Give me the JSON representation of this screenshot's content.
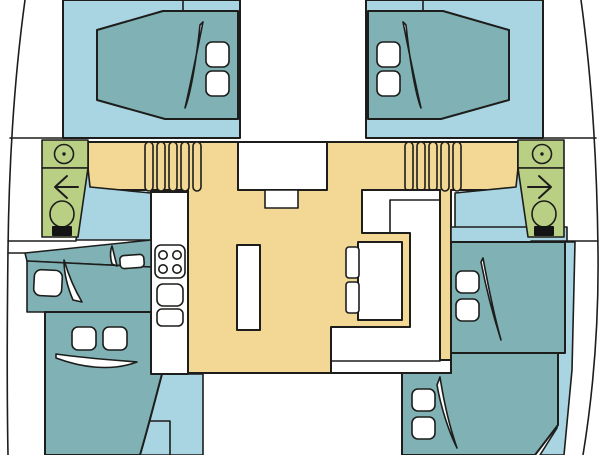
{
  "diagram": {
    "kind": "catamaran-yacht-floor-plan",
    "view": "top-down deck layout"
  },
  "colors": {
    "background": "#ffffff",
    "outline": "#1d1d1b",
    "hull_floor": "#a9d4e1",
    "furniture": "#7fb1b5",
    "salon_floor": "#f3d795",
    "bathroom": "#b9cf84",
    "fixture": "#ffffff",
    "toilet_tank": "#141414"
  },
  "inventory": {
    "cabins_with_double_bed": 4,
    "single_berths": 2,
    "bathrooms": 2,
    "stove_burners": 4,
    "galley_sinks": 2,
    "stair_steps_per_side": 5,
    "salon_seats": 2
  }
}
